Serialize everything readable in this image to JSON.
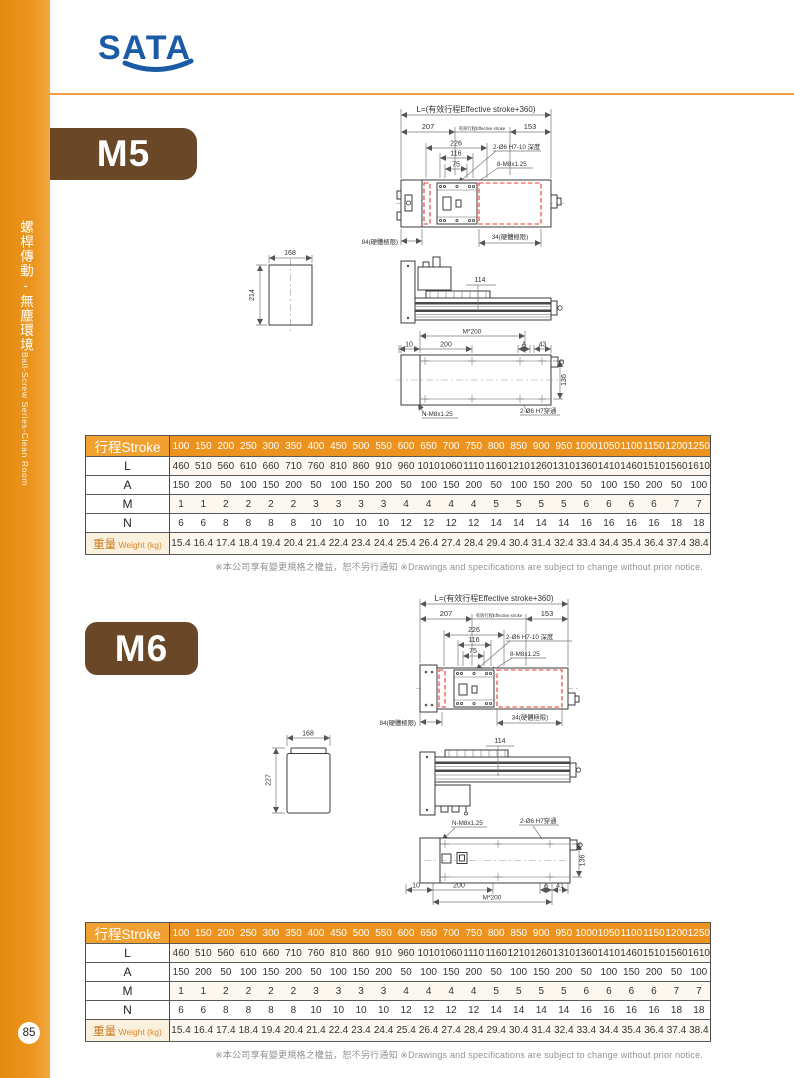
{
  "colors": {
    "accent_orange": "#ec921e",
    "badge_brown": "#6a4727",
    "logo_blue": "#1b5ba6",
    "drawing_red": "#e8382d"
  },
  "brand": {
    "logo_text": "SATA"
  },
  "sidebar": {
    "title_zh": "螺桿傳動-無塵環境",
    "title_en": "Ball-Screw Series-Clean Room",
    "page_number": "85"
  },
  "footnote": "※本公司享有變更規格之權益，恕不另行通知 ※Drawings and specifications are subject to change without prior notice.",
  "sections": [
    {
      "model": "M5",
      "drawing": {
        "l_total": "L=(有效行程Effective stroke+360)",
        "dim_207": "207",
        "effective_stroke": "有效行程Effective stroke",
        "dim_153": "153",
        "dim_226": "226",
        "dim_116": "116",
        "dim_75": "75",
        "hole_note": "2-Ø6 H7-10 深度",
        "screw_note": "8-M8x1.25",
        "limit_left": "84(硬體極限)",
        "limit_right": "34(硬體極限)",
        "section_width": "168",
        "section_height": "214",
        "dim_114": "114",
        "dim_m200": "M*200",
        "dim_10": "10",
        "dim_200": "200",
        "dim_a": "A",
        "dim_end": "43",
        "dim_136": "136",
        "bolt_note": "N-M8x1.25",
        "through_note": "2-Ø6 H7穿通"
      },
      "table": {
        "header_label": "行程Stroke",
        "strokes": [
          "100",
          "150",
          "200",
          "250",
          "300",
          "350",
          "400",
          "450",
          "500",
          "550",
          "600",
          "650",
          "700",
          "750",
          "800",
          "850",
          "900",
          "950",
          "1000",
          "1050",
          "1100",
          "1150",
          "1200",
          "1250"
        ],
        "rows": [
          {
            "label": "L",
            "values": [
              "460",
              "510",
              "560",
              "610",
              "660",
              "710",
              "760",
              "810",
              "860",
              "910",
              "960",
              "1010",
              "1060",
              "1110",
              "1160",
              "1210",
              "1260",
              "1310",
              "1360",
              "1410",
              "1460",
              "1510",
              "1560",
              "1610"
            ]
          },
          {
            "label": "A",
            "values": [
              "150",
              "200",
              "50",
              "100",
              "150",
              "200",
              "50",
              "100",
              "150",
              "200",
              "50",
              "100",
              "150",
              "200",
              "50",
              "100",
              "150",
              "200",
              "50",
              "100",
              "150",
              "200",
              "50",
              "100"
            ]
          },
          {
            "label": "M",
            "values": [
              "1",
              "1",
              "2",
              "2",
              "2",
              "2",
              "3",
              "3",
              "3",
              "3",
              "4",
              "4",
              "4",
              "4",
              "5",
              "5",
              "5",
              "5",
              "6",
              "6",
              "6",
              "6",
              "7",
              "7"
            ]
          },
          {
            "label": "N",
            "values": [
              "6",
              "6",
              "8",
              "8",
              "8",
              "8",
              "10",
              "10",
              "10",
              "10",
              "12",
              "12",
              "12",
              "12",
              "14",
              "14",
              "14",
              "14",
              "16",
              "16",
              "16",
              "16",
              "18",
              "18"
            ]
          },
          {
            "label": "重量",
            "label_en": "Weight (kg)",
            "values": [
              "15.4",
              "16.4",
              "17.4",
              "18.4",
              "19.4",
              "20.4",
              "21.4",
              "22.4",
              "23.4",
              "24.4",
              "25.4",
              "26.4",
              "27.4",
              "28.4",
              "29.4",
              "30.4",
              "31.4",
              "32.4",
              "33.4",
              "34.4",
              "35.4",
              "36.4",
              "37.4",
              "38.4"
            ]
          }
        ]
      }
    },
    {
      "model": "M6",
      "drawing": {
        "l_total": "L=(有效行程Effective stroke+360)",
        "dim_207": "207",
        "effective_stroke": "有效行程Effective stroke",
        "dim_153": "153",
        "dim_226": "226",
        "dim_116": "116",
        "dim_75": "75",
        "hole_note": "2-Ø6 H7-10 深度",
        "screw_note": "8-M8x1.25",
        "limit_left": "84(硬體極限)",
        "limit_right": "34(硬體極限)",
        "section_width": "168",
        "section_height": "227",
        "dim_114": "114",
        "dim_m200": "M*200",
        "dim_10": "10",
        "dim_200": "200",
        "dim_a": "A",
        "dim_end": "41",
        "dim_136": "136",
        "bolt_note": "N-M8x1.25",
        "through_note": "2-Ø6 H7穿通"
      },
      "table": {
        "header_label": "行程Stroke",
        "strokes": [
          "100",
          "150",
          "200",
          "250",
          "300",
          "350",
          "400",
          "450",
          "500",
          "550",
          "600",
          "650",
          "700",
          "750",
          "800",
          "850",
          "900",
          "950",
          "1000",
          "1050",
          "1100",
          "1150",
          "1200",
          "1250"
        ],
        "rows": [
          {
            "label": "L",
            "values": [
              "460",
              "510",
              "560",
              "610",
              "660",
              "710",
              "760",
              "810",
              "860",
              "910",
              "960",
              "1010",
              "1060",
              "1110",
              "1160",
              "1210",
              "1260",
              "1310",
              "1360",
              "1410",
              "1460",
              "1510",
              "1560",
              "1610"
            ]
          },
          {
            "label": "A",
            "values": [
              "150",
              "200",
              "50",
              "100",
              "150",
              "200",
              "50",
              "100",
              "150",
              "200",
              "50",
              "100",
              "150",
              "200",
              "50",
              "100",
              "150",
              "200",
              "50",
              "100",
              "150",
              "200",
              "50",
              "100"
            ]
          },
          {
            "label": "M",
            "values": [
              "1",
              "1",
              "2",
              "2",
              "2",
              "2",
              "3",
              "3",
              "3",
              "3",
              "4",
              "4",
              "4",
              "4",
              "5",
              "5",
              "5",
              "5",
              "6",
              "6",
              "6",
              "6",
              "7",
              "7"
            ]
          },
          {
            "label": "N",
            "values": [
              "6",
              "6",
              "8",
              "8",
              "8",
              "8",
              "10",
              "10",
              "10",
              "10",
              "12",
              "12",
              "12",
              "12",
              "14",
              "14",
              "14",
              "14",
              "16",
              "16",
              "16",
              "16",
              "18",
              "18"
            ]
          },
          {
            "label": "重量",
            "label_en": "Weight (kg)",
            "values": [
              "15.4",
              "16.4",
              "17.4",
              "18.4",
              "19.4",
              "20.4",
              "21.4",
              "22.4",
              "23.4",
              "24.4",
              "25.4",
              "26.4",
              "27.4",
              "28.4",
              "29.4",
              "30.4",
              "31.4",
              "32.4",
              "33.4",
              "34.4",
              "35.4",
              "36.4",
              "37.4",
              "38.4"
            ]
          }
        ]
      }
    }
  ]
}
